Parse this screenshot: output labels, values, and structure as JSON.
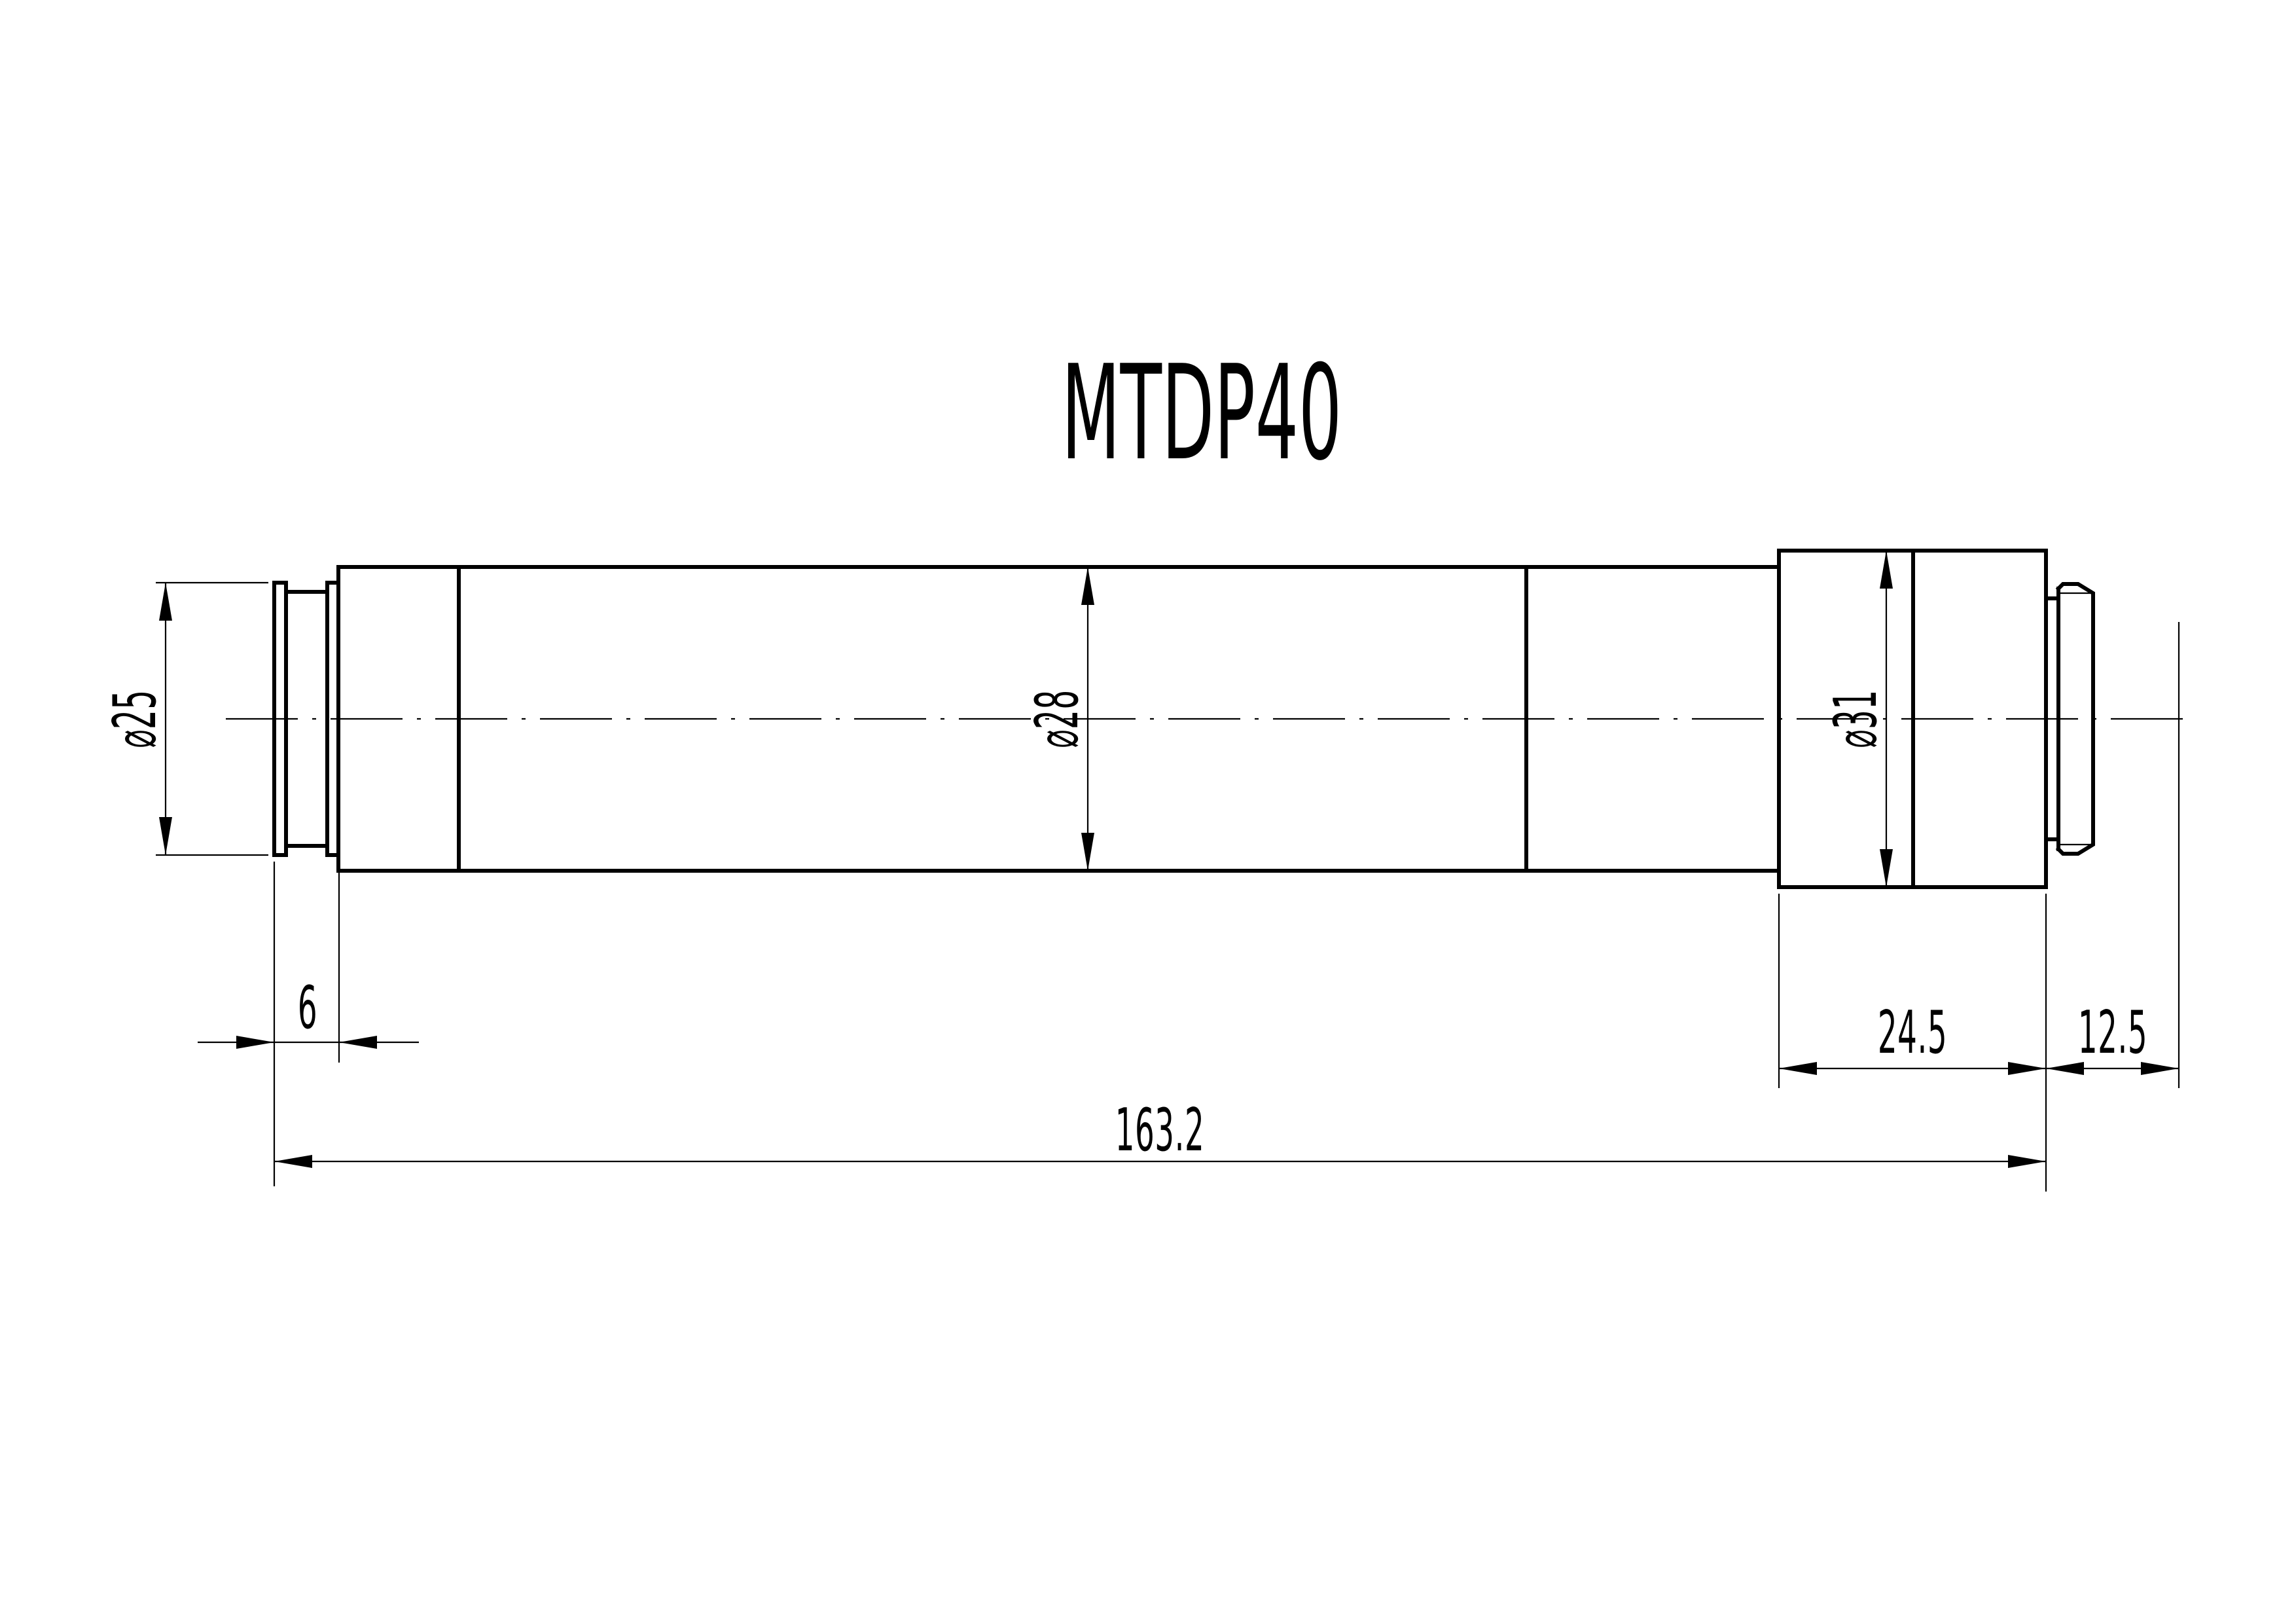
{
  "title": "MTDP40",
  "drawing": {
    "kind": "technical dimension drawing, side view of stepped cylindrical part",
    "units": "mm",
    "line_color": "#000000",
    "background": "#ffffff"
  },
  "dimensions": {
    "dia_left": {
      "label": "⌀25",
      "value": 25,
      "orientation": "vertical, rotated label, left of part"
    },
    "dia_mid": {
      "label": "⌀28",
      "value": 28,
      "orientation": "vertical, rotated label, inside main body"
    },
    "dia_right": {
      "label": "⌀31",
      "value": 31,
      "orientation": "vertical, rotated label, inside right block"
    },
    "nose_len": {
      "label": "6",
      "value": 6,
      "orientation": "horizontal, left nose section"
    },
    "block_len": {
      "label": "24.5",
      "value": 24.5,
      "orientation": "horizontal, right block"
    },
    "tail_len": {
      "label": "12.5",
      "value": 12.5,
      "orientation": "horizontal, right reference distance"
    },
    "overall_len": {
      "label": "163.2",
      "value": 163.2,
      "orientation": "horizontal, overall length"
    }
  }
}
